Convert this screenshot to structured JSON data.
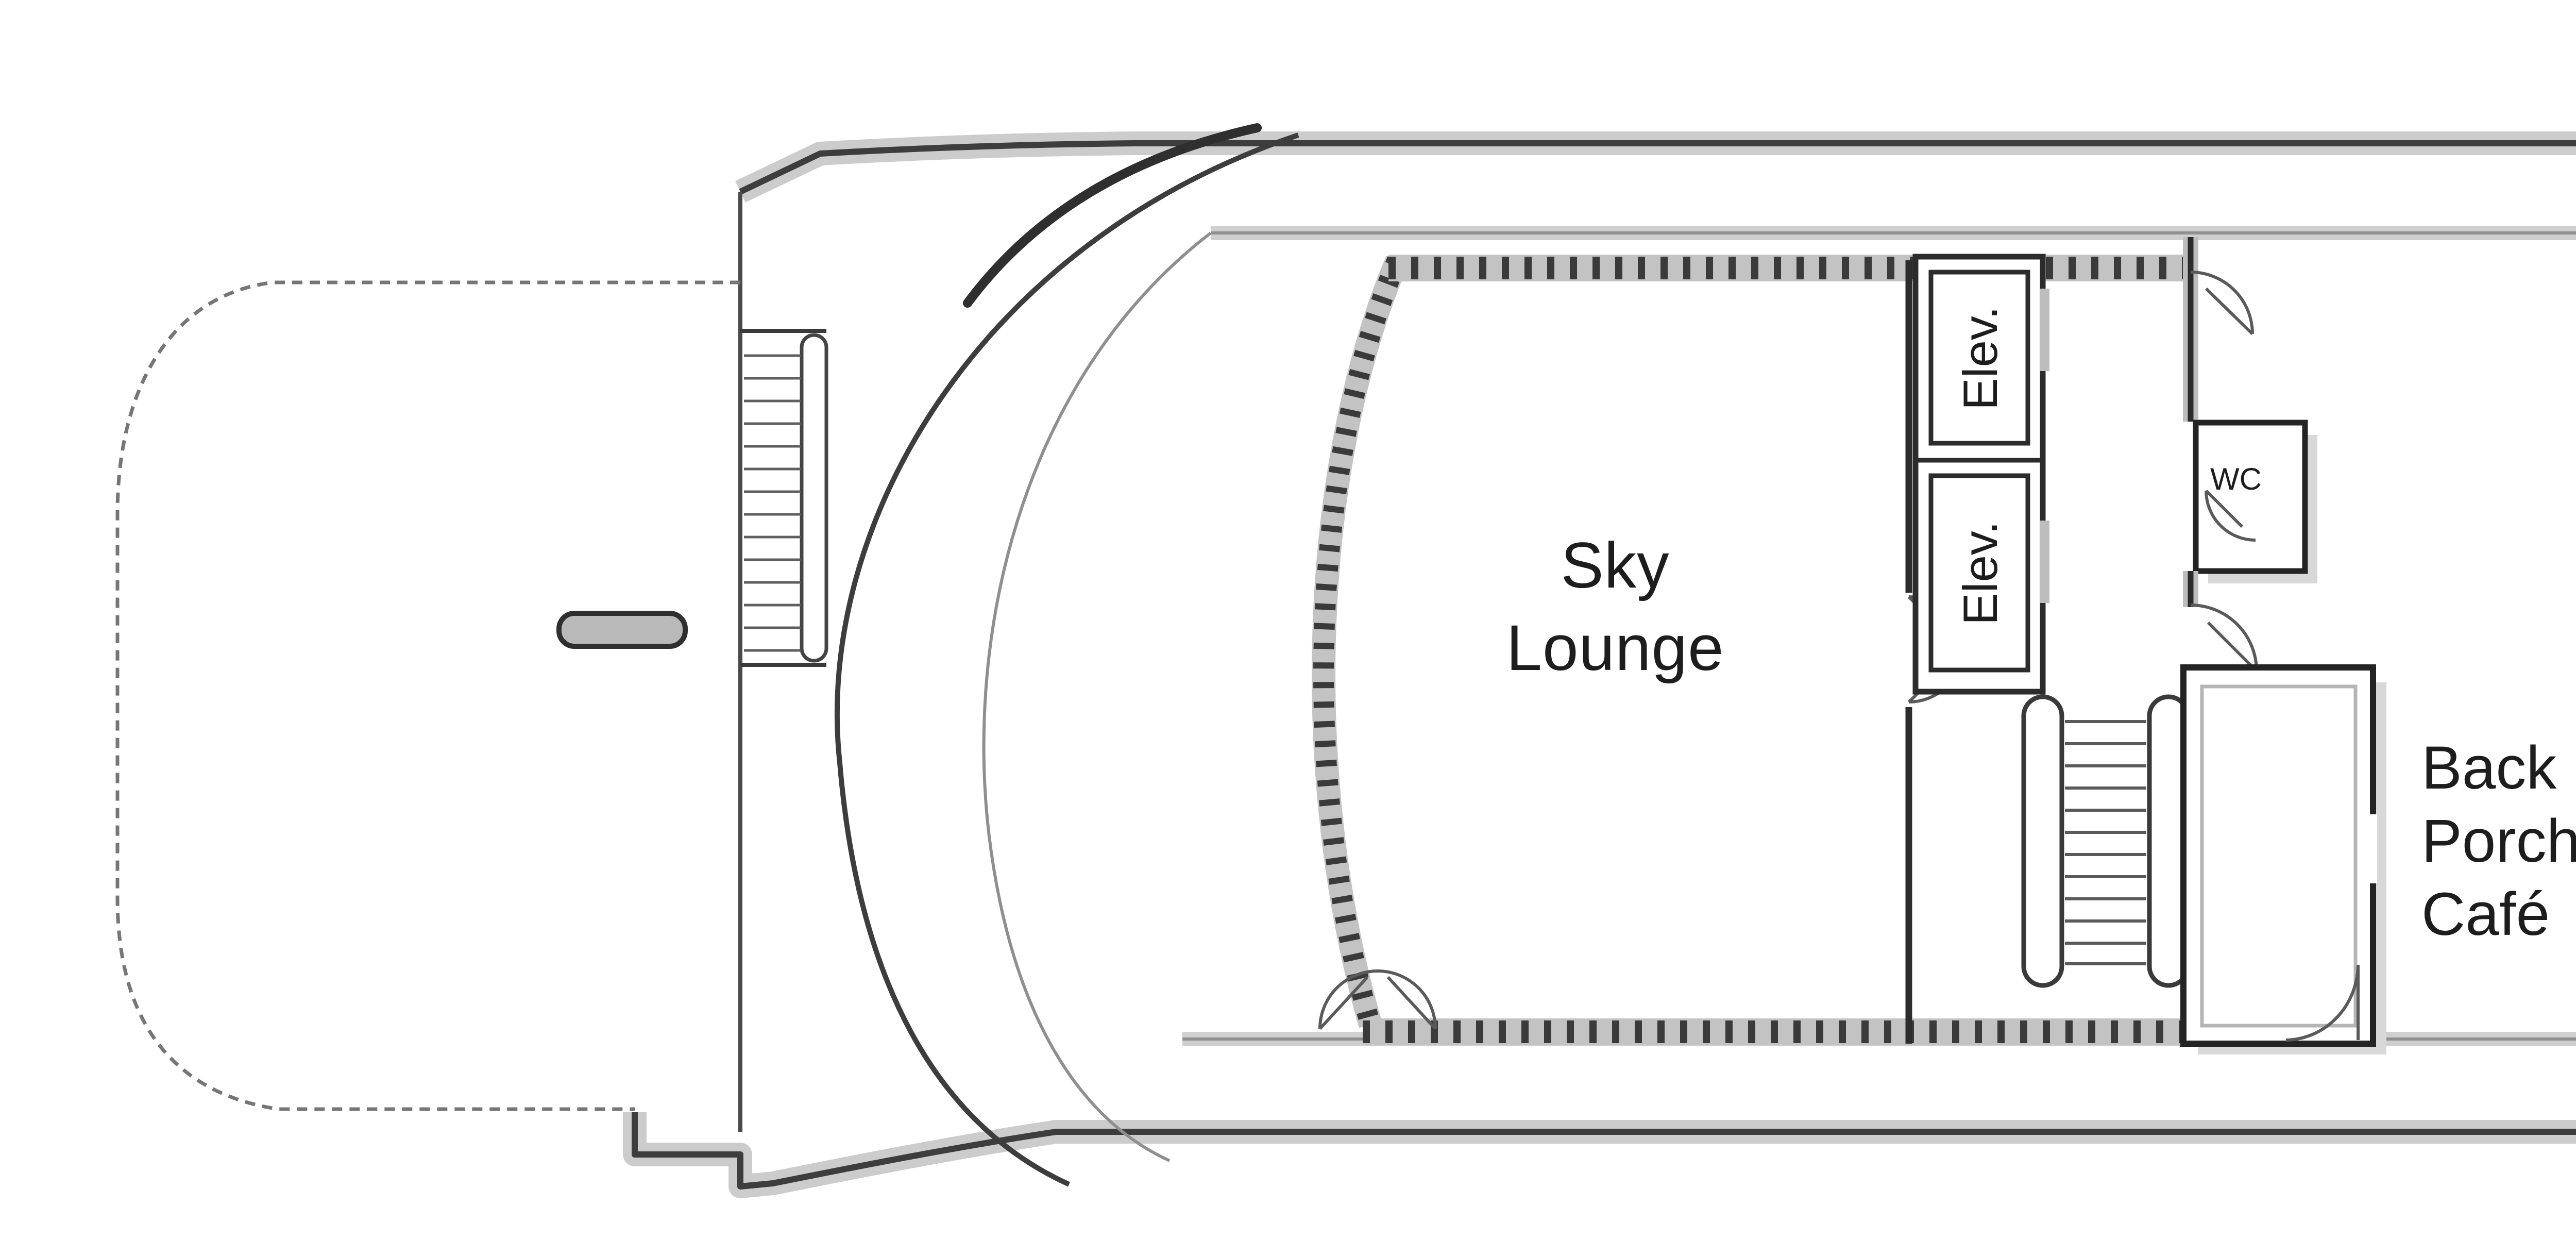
{
  "labels": {
    "sky_lounge": {
      "line1": "Sky",
      "line2": "Lounge"
    },
    "sun_deck": "Sun Deck",
    "back_porch_cafe": {
      "line1": "Back",
      "line2": "Porch",
      "line3": "Café"
    },
    "sky_walk": "Sky Walk",
    "wc": "WC",
    "elevator_forward": "Elev.",
    "elevator_aft": "Elev."
  },
  "colors": {
    "line_dark": "#3d3d3d",
    "line_mid": "#8f8f8f",
    "line_light": "#c4c4c4",
    "wall": "#3a3a3a",
    "background": "#ffffff",
    "shadow": "#d8d8d8"
  }
}
